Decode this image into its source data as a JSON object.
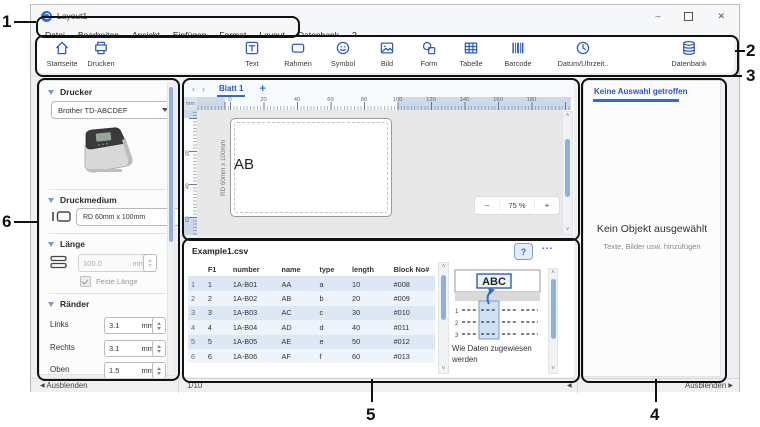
{
  "window": {
    "title": "Layout1",
    "minimize": "–",
    "maximize": "",
    "close": "✕"
  },
  "menu": {
    "items": [
      "Datei",
      "Bearbeiten",
      "Ansicht",
      "Einfügen",
      "Format",
      "Layout",
      "Datenbank",
      "?"
    ]
  },
  "toolbar": {
    "items": [
      {
        "label": "Startseite",
        "icon": "home-icon"
      },
      {
        "label": "Drucken",
        "icon": "print-icon"
      },
      {
        "label": "Text",
        "icon": "text-icon"
      },
      {
        "label": "Rahmen",
        "icon": "frame-icon"
      },
      {
        "label": "Symbol",
        "icon": "smiley-icon"
      },
      {
        "label": "Bild",
        "icon": "image-icon"
      },
      {
        "label": "Form",
        "icon": "shape-icon"
      },
      {
        "label": "Tabelle",
        "icon": "table-icon"
      },
      {
        "label": "Barcode",
        "icon": "barcode-icon"
      },
      {
        "label": "Datum/Uhrzeit..",
        "icon": "clock-icon"
      },
      {
        "label": "Datenbank",
        "icon": "database-icon"
      }
    ]
  },
  "sidebar": {
    "printer_section": {
      "title": "Drucker",
      "selected": "Brother TD-ABCDEF"
    },
    "media_section": {
      "title": "Druckmedium",
      "selected": "RD 60mm x 100mm"
    },
    "length_section": {
      "title": "Länge",
      "value": "100.0",
      "unit": "mm",
      "fixed_length_label": "Feste Länge"
    },
    "margins_section": {
      "title": "Ränder",
      "fields": [
        {
          "label": "Links",
          "value": "3.1",
          "unit": "mm"
        },
        {
          "label": "Rechts",
          "value": "3.1",
          "unit": "mm"
        },
        {
          "label": "Oben",
          "value": "1.5",
          "unit": "mm"
        }
      ]
    }
  },
  "canvas": {
    "prev": "‹",
    "next": "›",
    "sheet_tab": "Blatt 1",
    "add_tab": "+",
    "ruler_unit": "mm",
    "ruler_ticks": [
      "0",
      "20",
      "40",
      "60",
      "80",
      "100",
      "120",
      "140",
      "160",
      "180"
    ],
    "v_ruler_ticks": [
      "20",
      "40",
      "60"
    ],
    "label_text": "AB",
    "media_size_label": "RD 60mm x 100mm",
    "zoom": {
      "minus": "–",
      "value": "75 %",
      "plus": "+"
    }
  },
  "database": {
    "filename": "Example1.csv",
    "help_label": "?",
    "more_label": "...",
    "columns": [
      "F1",
      "number",
      "name",
      "type",
      "length",
      "Block No#"
    ],
    "rows": [
      [
        "1",
        "1",
        "1A-B01",
        "AA",
        "a",
        "10",
        "#008"
      ],
      [
        "2",
        "2",
        "1A-B02",
        "AB",
        "b",
        "20",
        "#009"
      ],
      [
        "3",
        "3",
        "1A-B03",
        "AC",
        "c",
        "30",
        "#010"
      ],
      [
        "4",
        "4",
        "1A-B04",
        "AD",
        "d",
        "40",
        "#011"
      ],
      [
        "5",
        "5",
        "1A-B05",
        "AE",
        "e",
        "50",
        "#012"
      ],
      [
        "6",
        "6",
        "1A-B06",
        "AF",
        "f",
        "60",
        "#013"
      ]
    ],
    "preview": {
      "sample_text": "ABC",
      "caption_line1": "Wie Daten zugewiesen",
      "caption_line2": "werden"
    }
  },
  "right_panel": {
    "header": "Keine Auswahl getroffen",
    "empty_title": "Kein Objekt ausgewählt",
    "empty_subtitle": "Texte, Bilder usw. hinzufügen"
  },
  "statusbar": {
    "hide_left": "Ausblenden",
    "page": "1/10",
    "hide_right": "Ausblenden",
    "arrow_left": "◀",
    "arrow_right": "▶"
  },
  "callouts": {
    "c1": "1",
    "c2": "2",
    "c3": "3",
    "c4": "4",
    "c5": "5",
    "c6": "6"
  }
}
